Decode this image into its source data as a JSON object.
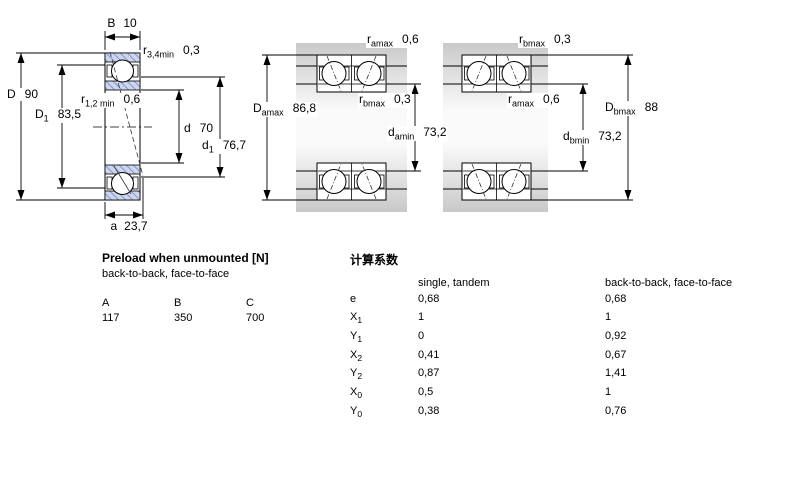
{
  "diagrams": {
    "left": {
      "B": {
        "sym": "B",
        "val": "10"
      },
      "r34": {
        "sym": "r",
        "sub": "3,4min",
        "val": "0,3"
      },
      "D": {
        "sym": "D",
        "val": "90"
      },
      "D1": {
        "sym": "D",
        "sub": "1",
        "val": "83,5"
      },
      "r12": {
        "sym": "r",
        "sub": "1,2 min",
        "val": "0,6"
      },
      "d": {
        "sym": "d",
        "val": "70"
      },
      "d1": {
        "sym": "d",
        "sub": "1",
        "val": "76,7"
      },
      "a": {
        "sym": "a",
        "val": "23,7"
      }
    },
    "middle": {
      "ramax": {
        "sym": "r",
        "sub": "amax",
        "val": "0,6"
      },
      "rbmax": {
        "sym": "r",
        "sub": "bmax",
        "val": "0,3"
      },
      "Damax": {
        "sym": "D",
        "sub": "amax",
        "val": "86,8"
      },
      "damin": {
        "sym": "d",
        "sub": "amin",
        "val": "73,2"
      }
    },
    "right": {
      "rbmax": {
        "sym": "r",
        "sub": "bmax",
        "val": "0,3"
      },
      "ramax": {
        "sym": "r",
        "sub": "amax",
        "val": "0,6"
      },
      "Dbmax": {
        "sym": "D",
        "sub": "bmax",
        "val": "88"
      },
      "dbmin": {
        "sym": "d",
        "sub": "bmin",
        "val": "73,2"
      }
    }
  },
  "preload_table": {
    "title": "Preload when unmounted [N]",
    "subtitle": "back-to-back, face-to-face",
    "columns": [
      "A",
      "B",
      "C"
    ],
    "values": [
      "117",
      "350",
      "700"
    ]
  },
  "factors_table": {
    "title": "计算系数",
    "col1_header": "single, tandem",
    "col2_header": "back-to-back, face-to-face",
    "rows": [
      {
        "sym": "e",
        "v1": "0,68",
        "v2": "0,68"
      },
      {
        "sym": "X",
        "sub": "1",
        "v1": "1",
        "v2": "1"
      },
      {
        "sym": "Y",
        "sub": "1",
        "v1": "0",
        "v2": "0,92"
      },
      {
        "sym": "X",
        "sub": "2",
        "v1": "0,41",
        "v2": "0,67"
      },
      {
        "sym": "Y",
        "sub": "2",
        "v1": "0,87",
        "v2": "1,41"
      },
      {
        "sym": "X",
        "sub": "0",
        "v1": "0,5",
        "v2": "1"
      },
      {
        "sym": "Y",
        "sub": "0",
        "v1": "0,38",
        "v2": "0,76"
      }
    ]
  },
  "colors": {
    "hatch_fill": "#cdd6ee",
    "hatch_line": "#8796c4",
    "housing_gray": "#c9c9c9",
    "line": "#000000"
  }
}
